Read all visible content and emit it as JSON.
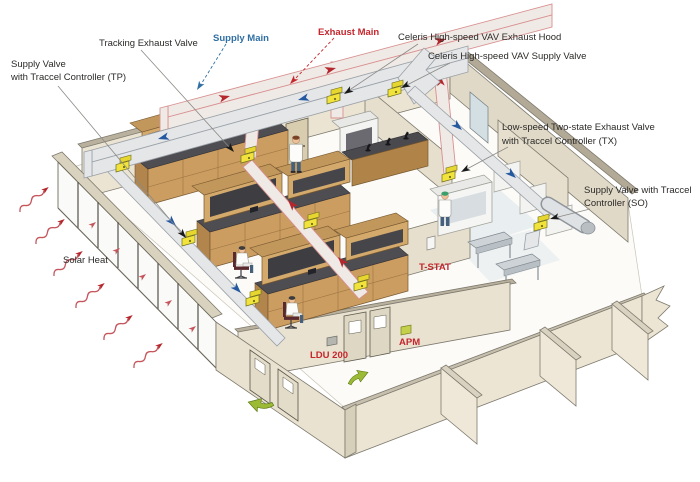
{
  "diagram": {
    "title": "Laboratory airflow control system isometric diagram",
    "labels": {
      "tp": {
        "line1": "Supply Valve",
        "line2": "with Traccel Controller (TP)"
      },
      "tracking": "Tracking Exhaust Valve",
      "supply_main": "Supply Main",
      "exhaust_main": "Exhaust Main",
      "celeris_hood": "Celeris High-speed VAV Exhaust Hood",
      "celeris_supply": "Celeris High-speed VAV Supply Valve",
      "tx": {
        "line1": "Low-speed Two-state Exhaust Valve",
        "line2": "with Traccel Controller (TX)"
      },
      "so": {
        "line1": "Supply Valve with Traccel",
        "line2": "Controller (SO)"
      },
      "solar_heat": "Solar Heat",
      "t_stat": "T-STAT",
      "ldu": "LDU 200",
      "apm": "APM"
    },
    "colors": {
      "supply_blue": "#2f6fa3",
      "exhaust_red": "#c4262d",
      "label_black": "#2b2a28",
      "flow_blue": "#2458a0",
      "flow_red": "#b5272d",
      "valve_yellow": "#f1e23c",
      "wall_beige": "#e9e2d1",
      "wood": "#cc9d60",
      "green_arrow": "#9cba36",
      "solar_red": "#c4555b"
    }
  }
}
